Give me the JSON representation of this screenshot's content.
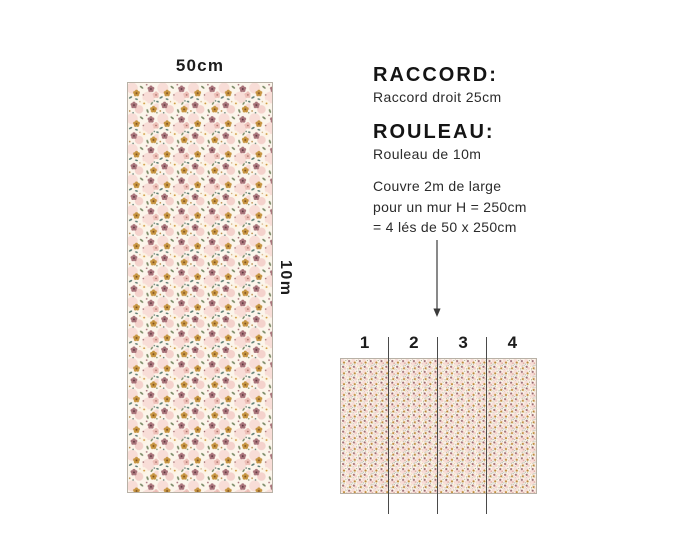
{
  "strip": {
    "width_label": "50cm",
    "height_label": "10m"
  },
  "specs": {
    "raccord_title": "RACCORD:",
    "raccord_text": "Raccord droit 25cm",
    "rouleau_title": "ROULEAU:",
    "rouleau_text": "Rouleau de 10m",
    "coverage_line1": "Couvre 2m de large",
    "coverage_line2": "pour un mur H = 250cm",
    "coverage_line3": "= 4 lés de 50 x 250cm"
  },
  "les": {
    "numbers": [
      "1",
      "2",
      "3",
      "4"
    ]
  },
  "pattern_colors": {
    "background": "#fcf5eb",
    "pink_patch": "#f8ddd7",
    "pink_patch_dark": "#f4d2cc",
    "mustard_flower": "#c69440",
    "mustard_center": "#7c4f22",
    "mauve_flower": "#a8737a",
    "mauve_center": "#5c383e",
    "cream_flower": "#fdf3e4",
    "cream_center": "#cf9a3e",
    "rose_flower": "#eebfb8",
    "rose_center": "#a0695f",
    "green_leaf": "#7b8a67",
    "teal_leaf": "#5e7d72",
    "border": "#b8b1a6"
  }
}
